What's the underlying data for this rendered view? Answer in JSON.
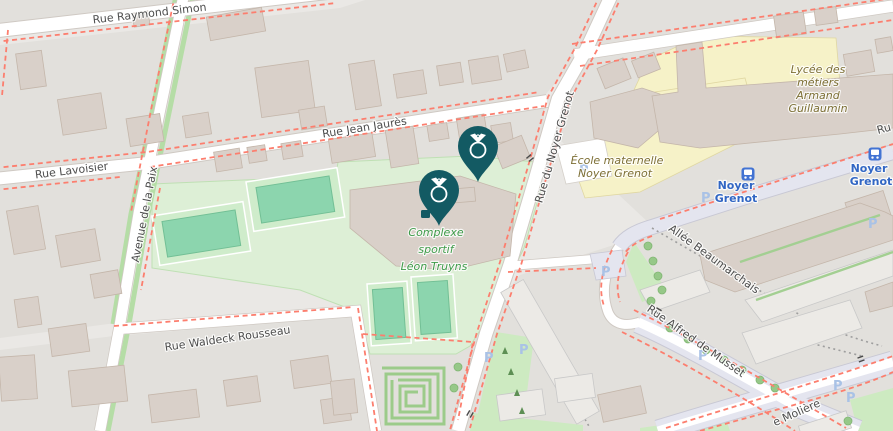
{
  "map": {
    "streets": {
      "raymond": "Rue Raymond Simon",
      "lavoisier": "Rue Lavoisier",
      "paix": "Avenue de la Paix",
      "jaures": "Rue Jean Jaurès",
      "waldeck": "Rue Waldeck Rousseau",
      "noyer": "Rue du Noyer Grenot",
      "beaumarchais": "Allée Beaumarchais",
      "musset": "Rue Alfred de Musset",
      "moliere": "e Molière",
      "edge_partial": "Ru"
    },
    "pois": {
      "complexe": [
        "Complexe",
        "sportif",
        "Léon Truyns"
      ],
      "ecole": [
        "École maternelle",
        "Noyer Grenot"
      ],
      "lycee": [
        "Lycée des",
        "métiers",
        "Armand",
        "Guillaumin"
      ]
    },
    "transit": {
      "stop1": [
        "Noyer",
        "Grenot"
      ],
      "stop2": [
        "Noyer",
        "Grenot"
      ]
    },
    "markers": [
      {
        "icon": "medal-pin"
      },
      {
        "icon": "medal-pin"
      }
    ],
    "parking_symbol": "P",
    "colors": {
      "pin_teal": "#135a63",
      "park_green": "#ddefd6",
      "court_teal": "#8cd5ae",
      "school_yellow": "#f6f2c8",
      "boundary_red": "#fc7e6e",
      "transit_blue": "#3166c4",
      "bus_icon_blue": "#4273d3",
      "parking_blue": "#a9c2e6",
      "poi_green": "#3f9b4a",
      "poi_brown": "#7d6f35",
      "street_gray": "#4d4d4d",
      "building_tan": "#d9d0c9"
    }
  }
}
